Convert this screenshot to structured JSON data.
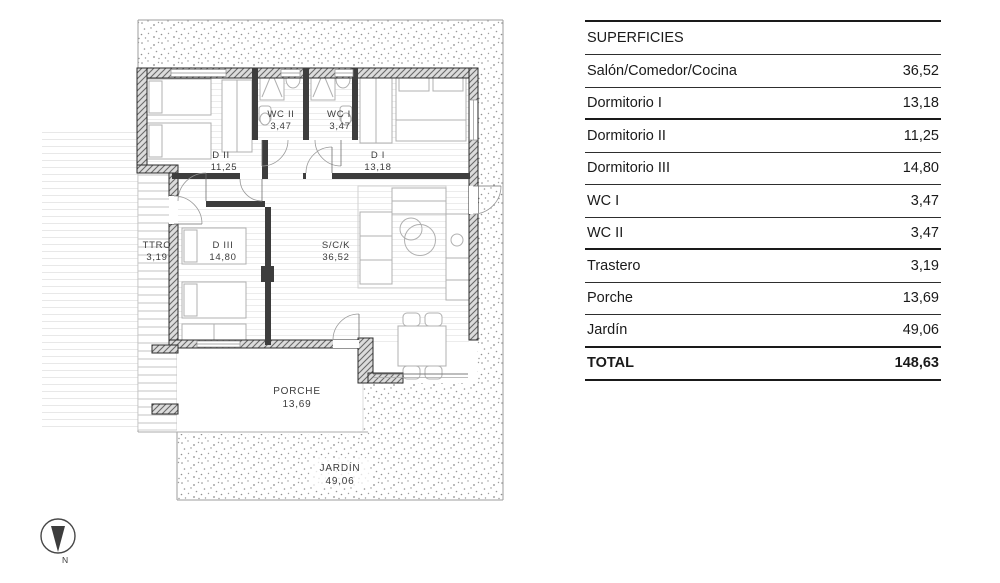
{
  "plan": {
    "rooms": {
      "d2": {
        "name": "D II",
        "area": "11,25"
      },
      "d1": {
        "name": "D I",
        "area": "13,18"
      },
      "wc2": {
        "name": "WC II",
        "area": "3,47"
      },
      "wc1": {
        "name": "WC I",
        "area": "3,47"
      },
      "ttro": {
        "name": "TTRO",
        "area": "3,19"
      },
      "d3": {
        "name": "D III",
        "area": "14,80"
      },
      "sck": {
        "name": "S/C/K",
        "area": "36,52"
      },
      "porche": {
        "name": "PORCHE",
        "area": "13,69"
      },
      "jardin": {
        "name": "JARDÍN",
        "area": "49,06"
      }
    },
    "compass": {
      "label": "N"
    }
  },
  "table": {
    "header": "SUPERFICIES",
    "rows": [
      {
        "label": "Salón/Comedor/Cocina",
        "value": "36,52"
      },
      {
        "label": "Dormitorio I",
        "value": "13,18"
      },
      {
        "label": "Dormitorio II",
        "value": "11,25"
      },
      {
        "label": "Dormitorio III",
        "value": "14,80"
      },
      {
        "label": "WC I",
        "value": "3,47"
      },
      {
        "label": "WC II",
        "value": "3,47"
      },
      {
        "label": "Trastero",
        "value": "3,19"
      },
      {
        "label": "Porche",
        "value": "13,69"
      },
      {
        "label": "Jardín",
        "value": "49,06"
      }
    ],
    "total": {
      "label": "TOTAL",
      "value": "148,63"
    }
  },
  "colors": {
    "ink": "#1a1a1a",
    "wall": "#3d3d3d",
    "plot_line": "#9e9e9e",
    "furniture_line": "#b0b0b0"
  }
}
